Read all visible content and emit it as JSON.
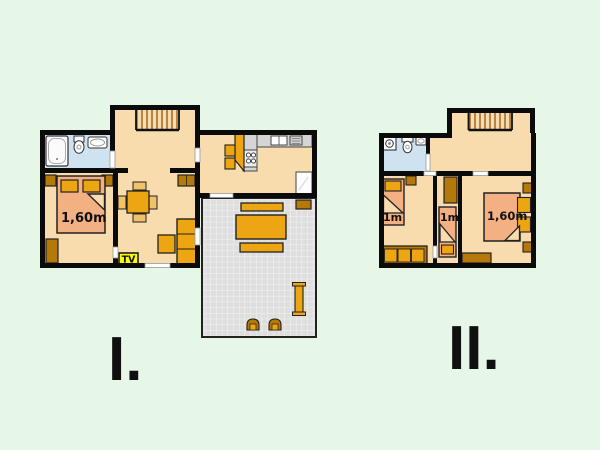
{
  "page": {
    "title": "apartment-floor-plans",
    "background": "#e7f7e7"
  },
  "plans": {
    "plan1": {
      "numeral": "I.",
      "labels": {
        "double_bed": "1,60m",
        "tv": "TV"
      }
    },
    "plan2": {
      "numeral": "II.",
      "labels": {
        "left_bed": "1m",
        "middle_bed": "1m",
        "double_bed": "1,60m"
      }
    }
  },
  "colors": {
    "background": "#e7f7e7",
    "wall": "#0b0b0b",
    "floor": "#f9dcae",
    "bathroom_floor": "#cfe2f0",
    "bed_mattress": "#f3b183",
    "furniture_orange": "#eda511",
    "furniture_light_orange": "#f2c269",
    "furniture_dark_orange": "#b5790a",
    "kitchen_counter": "#d5d5d5",
    "appliance_white": "#ffffff",
    "terrace_tile": "#dedede",
    "stair_tread": "#9a6a28",
    "tv_badge": "#fcfc00"
  },
  "icons": {
    "bathtub-icon": "rounded-rect-tub",
    "toilet-icon": "tank-plus-oval-bowl",
    "sink-icon": "basin-oval",
    "washing-machine-icon": "square-with-drum-circle",
    "stove-icon": "four-burner-circles",
    "kitchen-sink-icon": "double-basin-rect",
    "fridge-icon": "white-box",
    "stairs-icon": "tread-lines",
    "tv-icon": "yellow-tv-badge"
  }
}
